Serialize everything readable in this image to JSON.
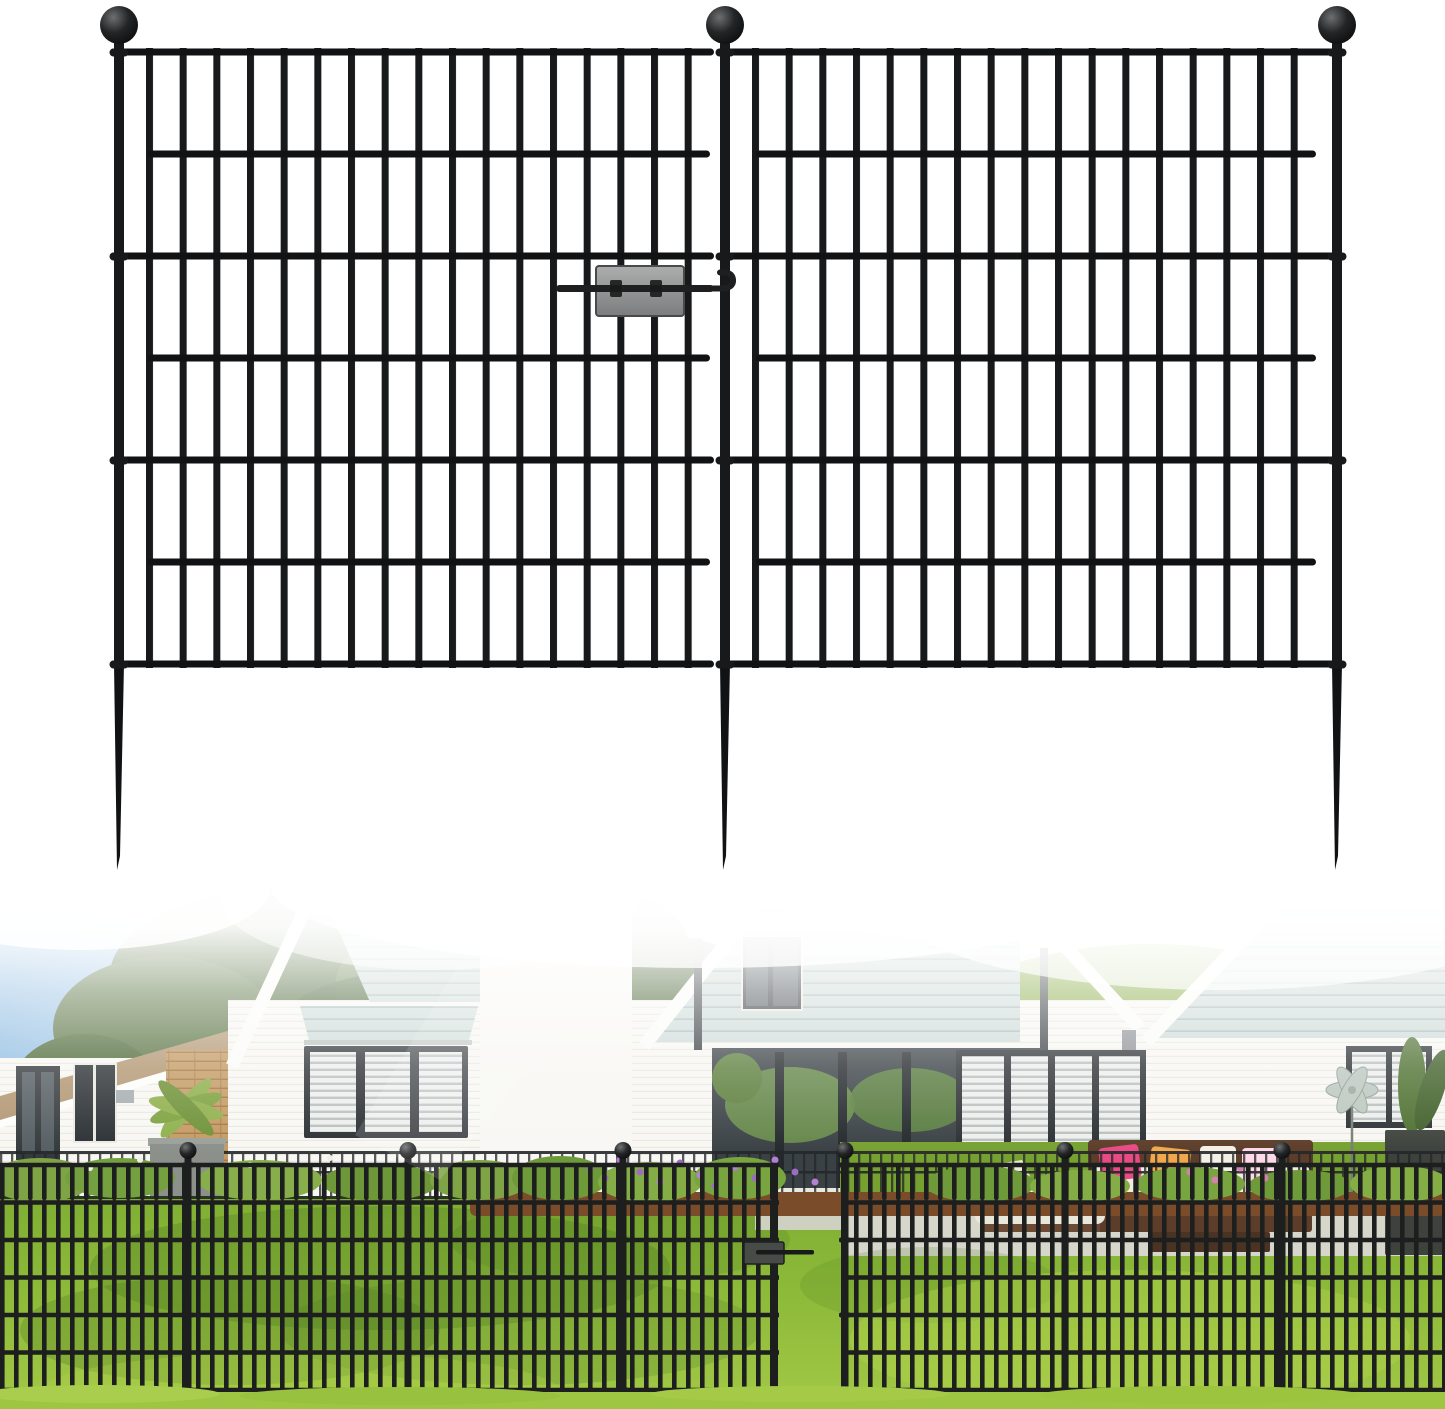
{
  "meta": {
    "description": "Product image: two black no-dig metal garden fence panels with ball-top stake posts and a connector clip, shown above a photo of the fence installed on a lawn in front of a white house with seafoam siding"
  },
  "product": {
    "panels": 2,
    "posts": 3,
    "post_finial": "ball",
    "rails_per_panel": 7,
    "pickets_per_panel": 18,
    "ground_stakes": true,
    "connector": "gray clip plate with latch pin"
  },
  "scene": {
    "setting": "front yard lawn",
    "house": "white brick house with seafoam horizontal siding and dark-framed windows",
    "foreground": "installed black fence panels with open gate gap and latch",
    "details": [
      "trees",
      "hedge",
      "flower bed with purple flowers",
      "patio sofa with pillows",
      "sun lounger",
      "garden spinner",
      "planters"
    ]
  },
  "colors": {
    "fence-black": "#17191b",
    "fence-rail": "#101214",
    "connector-gray": "#8f9193",
    "connector-dark": "#1d1f20",
    "sky-blue": "#8fbce2",
    "tree-dark": "#4c6836",
    "tree-mid": "#5e7c42",
    "hedge-light": "#89ac46",
    "hedge-mid": "#6f9238",
    "roof-tan": "#b29672",
    "wall-white": "#f8f7f3",
    "brick-tan": "#c49a64",
    "siding-seafoam": "#ccdad7",
    "siding-shadow": "#a7b9b5",
    "window-frame": "#2b3034",
    "glass-dark": "#4a5257",
    "blind-light": "#edefed",
    "blind-shadow": "#b9c0bf",
    "door-dark": "#34393c",
    "lawn-back": "#76a130",
    "lawn-front": "#9cc43f",
    "lawn-shadow": "#4f7a22",
    "mulch-brown": "#7a4c2a",
    "flower-purple": "#9c6cc0",
    "path-gray": "#d6d6cb",
    "sofa-brown": "#5c3d29",
    "cushion-white": "#f1ede3",
    "pillow-pink": "#e84a84",
    "pillow-orange": "#f2a74b",
    "pillow-yellow": "#e5d276",
    "planter-dark": "#3d423d",
    "spinner-silver": "#bcc8c0",
    "photo-fence": "#1c1f1e"
  }
}
